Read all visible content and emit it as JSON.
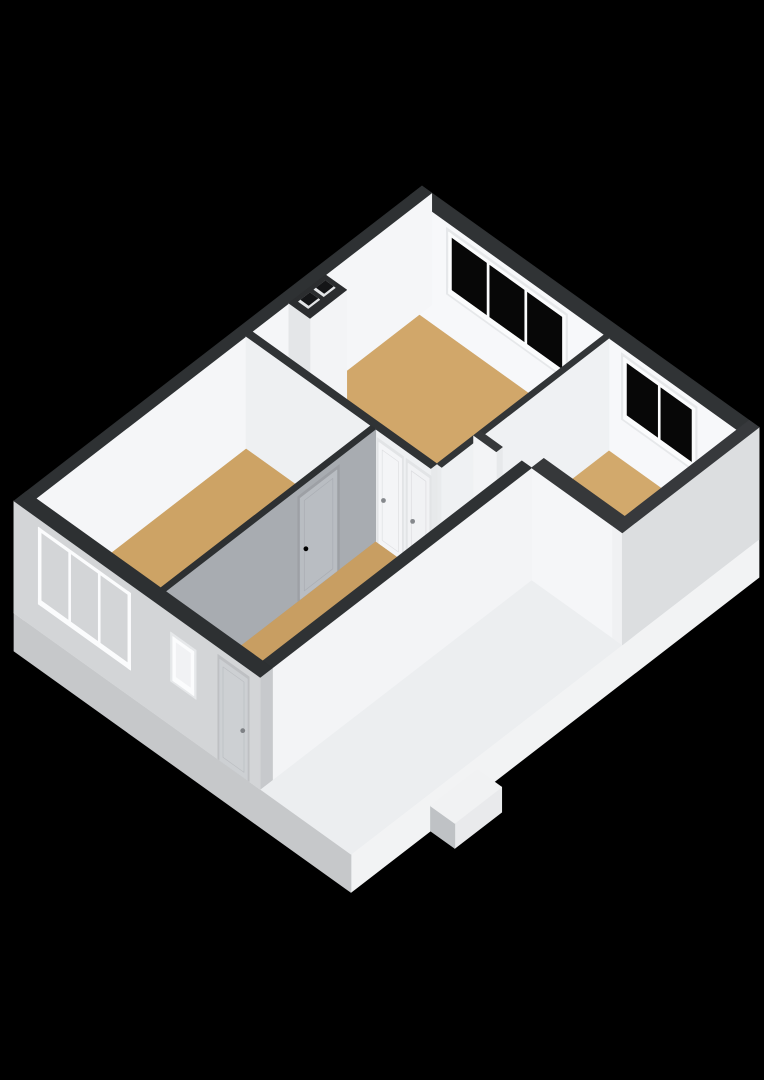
{
  "view": {
    "name": "3d-floor-plan-render",
    "background": "#000000",
    "canvas_width": 764,
    "canvas_height": 1080
  },
  "palette": {
    "wall_top": "#303335",
    "interior_white": "#f7f8fa",
    "exterior_light": "#d3d5d7",
    "fascia_bright": "#f2f3f4",
    "shadow_gray": "#a8acb1",
    "floor_tan": "#d1a76a",
    "slab_top": "#eceef0",
    "glass_dark": "#070707",
    "frame_white": "#fbfcfd",
    "handle_gray": "#85888c"
  },
  "scene": {
    "elements": [
      {
        "t": "box",
        "name": "floor-slab",
        "x": [
          0,
          10.4
        ],
        "y": [
          0,
          10
        ],
        "z": [
          -0.87,
          0
        ],
        "top": "#eceef0",
        "xf": "#f2f3f4",
        "yf": "#c6c8ca",
        "inter": false
      },
      {
        "t": "box",
        "name": "porch-step",
        "x": [
          10.4,
          11.15
        ],
        "y": [
          6.9,
          8.05
        ],
        "z": [
          -0.87,
          -0.3
        ],
        "top": "#f1f2f3",
        "xf": "#e9eaec",
        "yf": "#bfc2c5",
        "inter": false
      },
      {
        "t": "floor",
        "name": "floor-living-room",
        "pts": [
          [
            0.3,
            0.3
          ],
          [
            6.0,
            0.3
          ],
          [
            6.0,
            4.4
          ],
          [
            0.3,
            4.4
          ]
        ],
        "fill": "#d1a76a",
        "inter": true
      },
      {
        "t": "floor",
        "name": "floor-left-bedroom",
        "pts": [
          [
            0.3,
            4.55
          ],
          [
            4.15,
            4.55
          ],
          [
            4.15,
            9.7
          ],
          [
            0.3,
            9.7
          ]
        ],
        "fill": "#cda365",
        "inter": true
      },
      {
        "t": "floor",
        "name": "floor-right-bedroom",
        "pts": [
          [
            6.15,
            0.3
          ],
          [
            10.1,
            0.3
          ],
          [
            10.1,
            3.05
          ],
          [
            6.15,
            3.05
          ]
        ],
        "fill": "#d2a96c",
        "inter": true
      },
      {
        "t": "floor",
        "name": "floor-hallway",
        "pts": [
          [
            4.3,
            4.55
          ],
          [
            6.15,
            4.55
          ],
          [
            6.15,
            3.5
          ],
          [
            7.3,
            3.5
          ],
          [
            7.3,
            9.7
          ],
          [
            4.3,
            9.7
          ]
        ],
        "fill": "#c89e62",
        "inter": true
      },
      {
        "t": "wall",
        "name": "wall-north-east",
        "axis": "x",
        "x": [
          0,
          10.4
        ],
        "y": [
          0,
          0.3
        ],
        "z": [
          0,
          2.55
        ],
        "top": "#303335",
        "face": "#f7f8fa",
        "end": "#e8eaec",
        "openings": [
          {
            "kind": "window",
            "name": "window-living-room",
            "from": 1.2,
            "to": 4.8,
            "sill": 0.95,
            "head": 2.35,
            "panes": 3,
            "glass": "#070707",
            "jamb": true
          },
          {
            "kind": "window",
            "name": "window-right-bedroom",
            "from": 6.6,
            "to": 8.8,
            "sill": 0.95,
            "head": 2.35,
            "panes": 2,
            "glass": "#070707",
            "jamb": true
          }
        ]
      },
      {
        "t": "wall",
        "name": "wall-north-west",
        "axis": "y",
        "x": [
          0,
          0.3
        ],
        "y": [
          0,
          10
        ],
        "z": [
          0,
          2.55
        ],
        "top": "#2e3133",
        "face": "#f5f6f8",
        "end": "#eef0f1"
      },
      {
        "t": "box",
        "name": "chimney-breast",
        "x": [
          0.3,
          0.95
        ],
        "y": [
          2.6,
          3.5
        ],
        "z": [
          0,
          2.55
        ],
        "top": "#2b2d2f",
        "xf": "#f3f4f6",
        "yf": "#e4e6e8",
        "inter": false
      },
      {
        "t": "flue",
        "name": "chimney-flue-1",
        "x": [
          0.42,
          0.72
        ],
        "y": [
          2.7,
          2.98
        ],
        "z": 2.55,
        "lit": "#e3e5e7",
        "dark": "#141517"
      },
      {
        "t": "flue",
        "name": "chimney-flue-2",
        "x": [
          0.42,
          0.72
        ],
        "y": [
          3.08,
          3.36
        ],
        "z": 2.55,
        "lit": "#e3e5e7",
        "dark": "#141517"
      },
      {
        "t": "wall",
        "name": "wall-living-right-divider",
        "axis": "y",
        "x": [
          6.0,
          6.15
        ],
        "y": [
          0.3,
          3.35
        ],
        "z": [
          0,
          2.55
        ],
        "top": "#323537",
        "face": "#eff1f3",
        "end": "#ebedef"
      },
      {
        "t": "wall",
        "name": "wall-hall-right-divider",
        "axis": "y",
        "x": [
          6.0,
          6.15
        ],
        "y": [
          3.5,
          4.4
        ],
        "z": [
          0,
          2.55
        ],
        "top": "#323537",
        "face": "#eff1f3",
        "end": "#e9ebed"
      },
      {
        "t": "wall",
        "name": "wall-right-bedroom-stub",
        "axis": "x",
        "x": [
          6.0,
          6.7
        ],
        "y": [
          3.35,
          3.5
        ],
        "z": [
          0,
          2.55
        ],
        "top": "#36383a",
        "face": "#f3f4f6",
        "end": "#e7e9eb"
      },
      {
        "t": "wall",
        "name": "wall-right-bedroom-south",
        "axis": "x",
        "x": [
          7.6,
          10.4
        ],
        "y": [
          3.05,
          3.35
        ],
        "z": [
          0,
          2.55
        ],
        "top": "#36383a",
        "face": "#f5f6f8",
        "end": "#e8eaec"
      },
      {
        "t": "wall",
        "name": "wall-south-east",
        "axis": "y",
        "x": [
          10.1,
          10.4
        ],
        "y": [
          0,
          3.35
        ],
        "z": [
          0,
          2.55
        ],
        "top": "#37393c",
        "face": "#dcdee0",
        "end": "#f0f1f3"
      },
      {
        "t": "wall",
        "name": "wall-living-south",
        "axis": "x",
        "x": [
          0.3,
          6.0
        ],
        "y": [
          4.4,
          4.55
        ],
        "z": [
          0,
          2.55
        ],
        "top": "#303335",
        "face": "#eef0f2",
        "end": "#e7e9eb",
        "openings": [
          {
            "kind": "door",
            "name": "door-living-room-1",
            "from": 4.4,
            "to": 5.1,
            "sill": 0,
            "head": 2.3,
            "leaf": "#f4f5f7",
            "frame": "#e2e4e6",
            "handle": "#85888c",
            "hside": "left"
          },
          {
            "kind": "door",
            "name": "door-living-room-2",
            "from": 5.3,
            "to": 5.95,
            "sill": 0,
            "head": 2.3,
            "leaf": "#f1f2f4",
            "frame": "#e2e4e6",
            "handle": "#85888c",
            "hside": "left"
          }
        ]
      },
      {
        "t": "wall",
        "name": "wall-left-bedroom-divider",
        "axis": "y",
        "x": [
          4.15,
          4.3
        ],
        "y": [
          4.55,
          9.7
        ],
        "z": [
          0,
          2.55
        ],
        "top": "#2d3032",
        "face": "#a8acb1",
        "end": "#cfd1d4",
        "openings": [
          {
            "kind": "door",
            "name": "door-left-bedroom",
            "from": 5.5,
            "to": 6.4,
            "sill": 0,
            "head": 2.3,
            "leaf": "#b9bdc2",
            "frame": "#9da0a5",
            "handle": "#6f7control275",
            "hside": "right"
          }
        ]
      },
      {
        "t": "box",
        "name": "doormat",
        "x": [
          5.55,
          6.1
        ],
        "y": [
          9.38,
          9.68
        ],
        "z": [
          0,
          0.1
        ],
        "top": "#dcb67f",
        "xf": "#c9a46f",
        "yf": "#bf9a66",
        "inter": false
      },
      {
        "t": "toilet",
        "name": "toilet",
        "cx": 7.0,
        "cy": 9.22,
        "tank": {
          "x": [
            6.78,
            7.18
          ],
          "y": [
            9.5,
            9.7
          ]
        }
      },
      {
        "t": "wall",
        "name": "wall-hallway-east",
        "axis": "y",
        "x": [
          7.3,
          7.6
        ],
        "y": [
          3.35,
          10
        ],
        "z": [
          0,
          2.55
        ],
        "top": "#2f3234",
        "face": "#f3f4f6",
        "end": "#e2e4e6"
      },
      {
        "t": "wall",
        "name": "wall-south-west",
        "axis": "x",
        "x": [
          0,
          7.6
        ],
        "y": [
          9.7,
          10
        ],
        "z": [
          0,
          2.55
        ],
        "top": "#2d3032",
        "face": "#d3d5d7",
        "end": "#c7c9cc",
        "openings": [
          {
            "kind": "window",
            "name": "window-left-bedroom",
            "from": 0.75,
            "to": 3.6,
            "sill": 0.6,
            "head": 2.35,
            "panes": 3,
            "glass": "",
            "jamb": false
          },
          {
            "kind": "window",
            "name": "window-hallway",
            "from": 4.9,
            "to": 5.55,
            "sill": 1.05,
            "head": 2.05,
            "panes": 1,
            "glass": "rgba(242,243,245,0.88)",
            "jamb": true
          },
          {
            "kind": "door",
            "name": "door-entrance",
            "from": 6.35,
            "to": 7.2,
            "sill": 0,
            "head": 2.3,
            "leaf": "#cdd0d3",
            "frame": "#bec0c3",
            "handle": "#7e8185",
            "hside": "right"
          }
        ]
      }
    ]
  }
}
